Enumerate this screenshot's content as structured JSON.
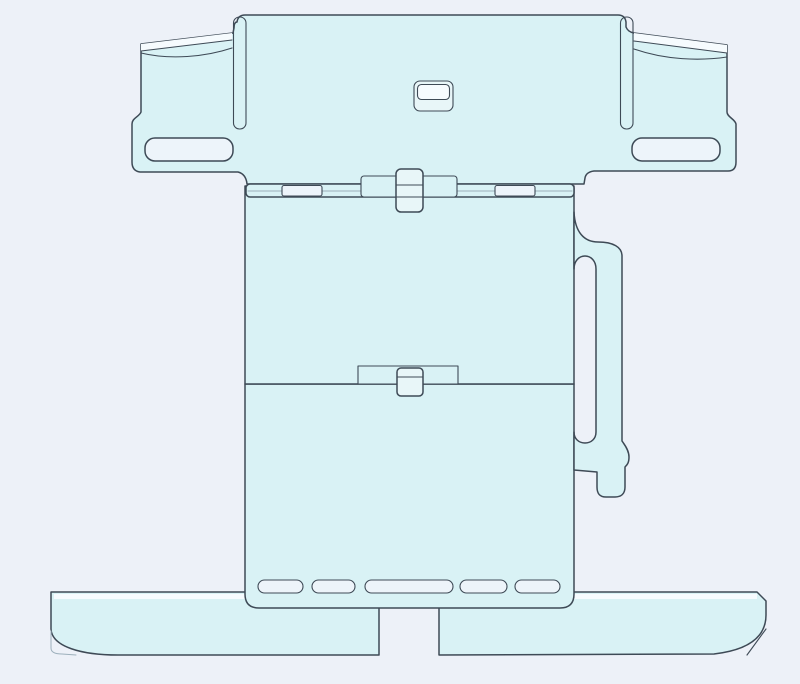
{
  "canvas": {
    "width": 800,
    "height": 684,
    "background_color": "#edf1f8"
  },
  "model": {
    "description": "CAD model of a flat sheet bracket part, front view, no text labels",
    "colors": {
      "part_fill": "#d9f2f5",
      "part_soft_fill": "#e8f6f8",
      "cutout_fill": "#edf4fa",
      "edge_highlight": "#f6fbfe",
      "outline": "#3e4a56",
      "light_line": "#9db0bc"
    },
    "components": {
      "top_plate": "wide upper plate with left and right cup-shaped end pockets",
      "left_cup": "cup pocket on upper left with curved rim",
      "right_cup": "cup pocket on upper right with curved rim",
      "top_plate_slots": 2,
      "center_button": "small rounded latch button at top plate center",
      "hinge_strip": "thin hinge strip under the top plate with two link windows",
      "hinge_knob": "center hinge knob crossing the strip",
      "middle_panel": "large middle rectangular panel",
      "handle_loop": "vertical handle loop with elongated slot on right side",
      "divider_tab": "latch tab at the middle/lower panel divider",
      "lower_panel": "lower rectangular panel with rounded bottom corners",
      "vent_slots": 5,
      "base_plate": "wide flat base with rounded lower corners",
      "base_notch": "rectangular notch cut in base bottom center"
    }
  }
}
